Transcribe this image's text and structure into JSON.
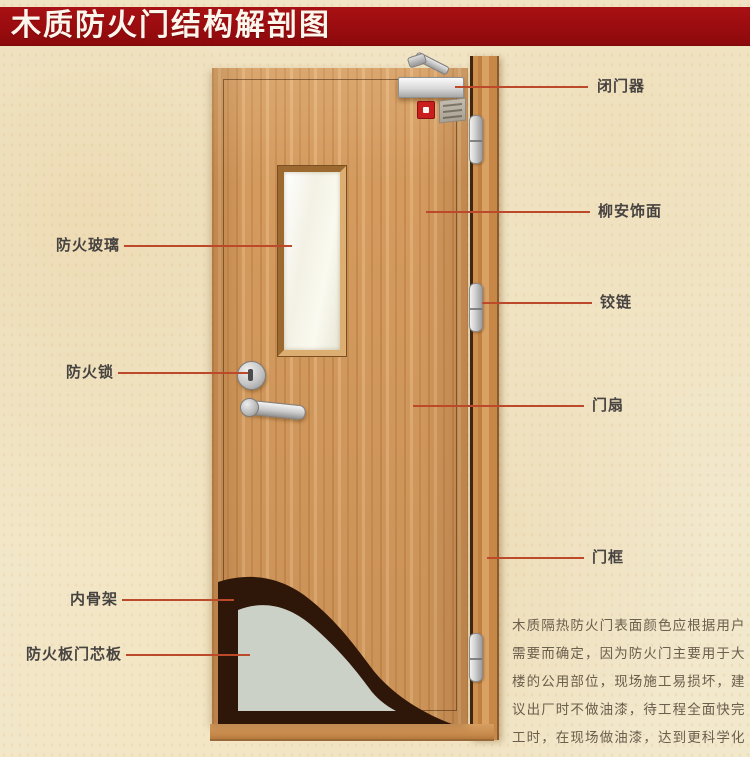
{
  "title": {
    "text": "木质防火门结构解剖图"
  },
  "labels": {
    "right": [
      {
        "id": "door-closer",
        "text": "闭门器"
      },
      {
        "id": "lauan-veneer",
        "text": "柳安饰面"
      },
      {
        "id": "hinge",
        "text": "铰链"
      },
      {
        "id": "door-leaf",
        "text": "门扇"
      },
      {
        "id": "door-frame",
        "text": "门框"
      }
    ],
    "left": [
      {
        "id": "fire-glass",
        "text": "防火玻璃"
      },
      {
        "id": "fire-lock",
        "text": "防火锁"
      },
      {
        "id": "inner-skeleton",
        "text": "内骨架"
      },
      {
        "id": "fire-core-board",
        "text": "防火板门芯板"
      }
    ]
  },
  "description": {
    "text": "木质隔热防火门表面颜色应根据用户需要而确定，因为防火门主要用于大楼的公用部位，现场施工易损坏，建议出厂时不做油漆，待工程全面快完工时，在现场做油漆，达到更科学化更人性化的服务。"
  },
  "colors": {
    "title_bar": "#9a0c0f",
    "leader_line": "#bc4a2a",
    "label_text": "#474340",
    "door_wood": "#d49a5e",
    "core_board_gray": "#ccd1c8",
    "inner_skeleton_brown": "#2e1608",
    "background_parchment": "#f2e8cc"
  }
}
